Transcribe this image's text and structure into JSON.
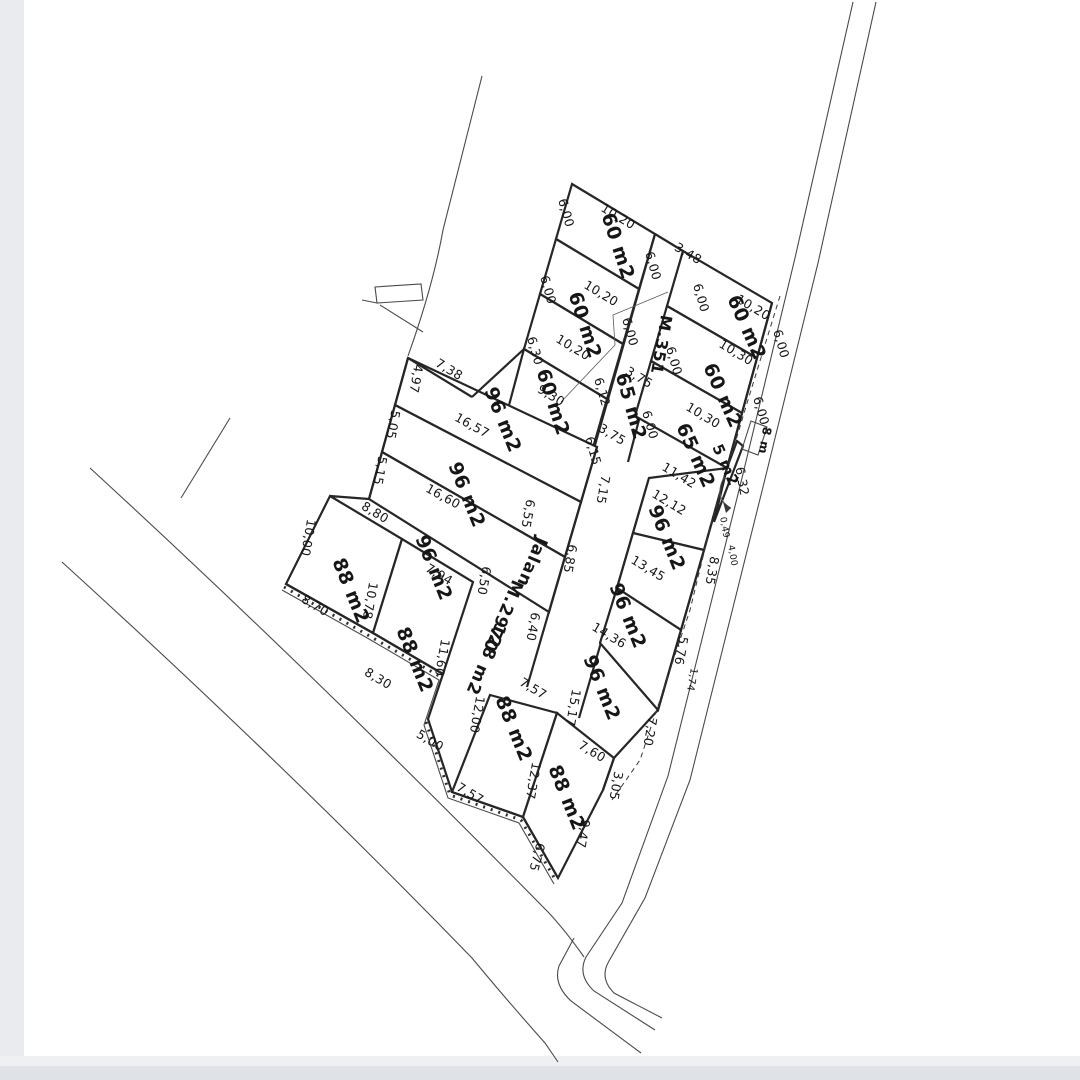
{
  "drawing": {
    "type": "land-subdivision-survey-plan",
    "paper_color": "#ffffff",
    "line_color": "#262626",
    "edge_band_color": "#e9ebee",
    "bottom_band_color": "#dfe3e7"
  },
  "roads": {
    "main_road_name": "Jalan",
    "main_road_id": "M.2970",
    "main_road_area": "128 m2",
    "corridor_id": "M.351",
    "width_marker": "8 m"
  },
  "plot_areas_summary": [
    "60 m2",
    "60 m2",
    "60 m2",
    "65 m2",
    "60 m2",
    "60 m2",
    "65 m2",
    "5 m2",
    "96 m2",
    "96 m2",
    "96 m2",
    "88 m2",
    "88 m2",
    "96 m2",
    "96 m2",
    "96 m2",
    "88 m2",
    "88 m2"
  ],
  "labels": {
    "areas": [
      {
        "t": "60 m2",
        "x": 612,
        "y": 248,
        "r": 72
      },
      {
        "t": "60 m2",
        "x": 579,
        "y": 327,
        "r": 72
      },
      {
        "t": "60 m2",
        "x": 547,
        "y": 404,
        "r": 72
      },
      {
        "t": "65 m2",
        "x": 625,
        "y": 408,
        "r": 74
      },
      {
        "t": "60 m2",
        "x": 741,
        "y": 330,
        "r": 66
      },
      {
        "t": "60 m2",
        "x": 717,
        "y": 398,
        "r": 66
      },
      {
        "t": "65 m2",
        "x": 690,
        "y": 458,
        "r": 66
      },
      {
        "t": "5 m2",
        "x": 721,
        "y": 467,
        "r": 66,
        "s": 15
      },
      {
        "t": "96 m2",
        "x": 497,
        "y": 422,
        "r": 68
      },
      {
        "t": "96 m2",
        "x": 461,
        "y": 497,
        "r": 68
      },
      {
        "t": "96 m2",
        "x": 428,
        "y": 570,
        "r": 68
      },
      {
        "t": "88 m2",
        "x": 345,
        "y": 593,
        "r": 68
      },
      {
        "t": "88 m2",
        "x": 409,
        "y": 662,
        "r": 68
      },
      {
        "t": "96 m2",
        "x": 661,
        "y": 540,
        "r": 68
      },
      {
        "t": "96 m2",
        "x": 622,
        "y": 618,
        "r": 68
      },
      {
        "t": "96 m2",
        "x": 596,
        "y": 690,
        "r": 68
      },
      {
        "t": "88 m2",
        "x": 508,
        "y": 731,
        "r": 68
      },
      {
        "t": "88 m2",
        "x": 561,
        "y": 800,
        "r": 68
      }
    ],
    "roads": [
      {
        "t": "Jalan",
        "x": 527,
        "y": 560,
        "r": 113,
        "s": 17
      },
      {
        "t": "M.2970",
        "x": 498,
        "y": 614,
        "r": 113,
        "s": 17
      },
      {
        "t": "128 m2",
        "x": 481,
        "y": 657,
        "r": 113,
        "s": 17
      },
      {
        "t": "M.351",
        "x": 656,
        "y": 344,
        "r": 100,
        "s": 16
      },
      {
        "t": "8 m",
        "x": 761,
        "y": 440,
        "r": 100,
        "s": 12
      }
    ],
    "dims": [
      {
        "t": "6,00",
        "x": 562,
        "y": 214,
        "r": 74
      },
      {
        "t": "10,20",
        "x": 616,
        "y": 220,
        "r": 31
      },
      {
        "t": "10,20",
        "x": 599,
        "y": 297,
        "r": 31
      },
      {
        "t": "6,00",
        "x": 544,
        "y": 291,
        "r": 74
      },
      {
        "t": "10,20",
        "x": 571,
        "y": 351,
        "r": 31
      },
      {
        "t": "6,30",
        "x": 531,
        "y": 352,
        "r": 74
      },
      {
        "t": "9,30",
        "x": 549,
        "y": 399,
        "r": 31
      },
      {
        "t": "6,00",
        "x": 649,
        "y": 267,
        "r": 74
      },
      {
        "t": "6,00",
        "x": 626,
        "y": 333,
        "r": 74
      },
      {
        "t": "3,48",
        "x": 686,
        "y": 257,
        "r": 31
      },
      {
        "t": "6,00",
        "x": 697,
        "y": 299,
        "r": 74
      },
      {
        "t": "3,75",
        "x": 637,
        "y": 381,
        "r": 31
      },
      {
        "t": "3,75",
        "x": 610,
        "y": 438,
        "r": 31
      },
      {
        "t": "6,12",
        "x": 598,
        "y": 393,
        "r": 74
      },
      {
        "t": "6,15",
        "x": 589,
        "y": 452,
        "r": 74
      },
      {
        "t": "10,20",
        "x": 751,
        "y": 311,
        "r": 31
      },
      {
        "t": "10,30",
        "x": 734,
        "y": 356,
        "r": 31
      },
      {
        "t": "6,00",
        "x": 777,
        "y": 345,
        "r": 74
      },
      {
        "t": "10,30",
        "x": 701,
        "y": 419,
        "r": 31
      },
      {
        "t": "6,00",
        "x": 670,
        "y": 362,
        "r": 74
      },
      {
        "t": "6,00",
        "x": 646,
        "y": 426,
        "r": 74
      },
      {
        "t": "6,00",
        "x": 757,
        "y": 412,
        "r": 74
      },
      {
        "t": "11,42",
        "x": 677,
        "y": 479,
        "r": 31
      },
      {
        "t": "12,12",
        "x": 667,
        "y": 506,
        "r": 31
      },
      {
        "t": "6,32",
        "x": 738,
        "y": 482,
        "r": 80
      },
      {
        "t": "0,49",
        "x": 722,
        "y": 528,
        "r": 80,
        "s": 9
      },
      {
        "t": "4,00",
        "x": 730,
        "y": 556,
        "r": 80,
        "s": 9
      },
      {
        "t": "7,38",
        "x": 447,
        "y": 373,
        "r": 31
      },
      {
        "t": "4,97",
        "x": 412,
        "y": 378,
        "r": 100
      },
      {
        "t": "5,05",
        "x": 389,
        "y": 424,
        "r": 100
      },
      {
        "t": "5,15",
        "x": 376,
        "y": 470,
        "r": 100
      },
      {
        "t": "16,57",
        "x": 470,
        "y": 429,
        "r": 29
      },
      {
        "t": "16,60",
        "x": 441,
        "y": 500,
        "r": 29
      },
      {
        "t": "6,55",
        "x": 524,
        "y": 513,
        "r": 100
      },
      {
        "t": "8,80",
        "x": 373,
        "y": 516,
        "r": 31
      },
      {
        "t": "7,94",
        "x": 437,
        "y": 578,
        "r": 31
      },
      {
        "t": "6,50",
        "x": 480,
        "y": 580,
        "r": 100
      },
      {
        "t": "10,00",
        "x": 304,
        "y": 537,
        "r": 100
      },
      {
        "t": "8,70",
        "x": 313,
        "y": 609,
        "r": 31
      },
      {
        "t": "10,78",
        "x": 366,
        "y": 600,
        "r": 100
      },
      {
        "t": "8,30",
        "x": 376,
        "y": 682,
        "r": 31
      },
      {
        "t": "11,60",
        "x": 438,
        "y": 657,
        "r": 100
      },
      {
        "t": "12,00",
        "x": 473,
        "y": 714,
        "r": 100
      },
      {
        "t": "5,00",
        "x": 428,
        "y": 744,
        "r": 31
      },
      {
        "t": "7,57",
        "x": 531,
        "y": 692,
        "r": 31
      },
      {
        "t": "7,57",
        "x": 468,
        "y": 797,
        "r": 31
      },
      {
        "t": "15,17",
        "x": 569,
        "y": 707,
        "r": 100
      },
      {
        "t": "7,15",
        "x": 599,
        "y": 489,
        "r": 100
      },
      {
        "t": "6,85",
        "x": 566,
        "y": 558,
        "r": 100
      },
      {
        "t": "6,40",
        "x": 529,
        "y": 626,
        "r": 100
      },
      {
        "t": "13,45",
        "x": 646,
        "y": 572,
        "r": 31
      },
      {
        "t": "14,36",
        "x": 607,
        "y": 639,
        "r": 31
      },
      {
        "t": "8,35",
        "x": 708,
        "y": 570,
        "r": 100
      },
      {
        "t": "5,76",
        "x": 677,
        "y": 650,
        "r": 100
      },
      {
        "t": "1,74",
        "x": 689,
        "y": 679,
        "r": 100,
        "s": 10
      },
      {
        "t": "7,20",
        "x": 646,
        "y": 731,
        "r": 100
      },
      {
        "t": "7,60",
        "x": 590,
        "y": 755,
        "r": 31
      },
      {
        "t": "3,05",
        "x": 612,
        "y": 785,
        "r": 100
      },
      {
        "t": "12,37",
        "x": 529,
        "y": 780,
        "r": 100
      },
      {
        "t": "9,47",
        "x": 579,
        "y": 833,
        "r": 100
      },
      {
        "t": "6,75",
        "x": 533,
        "y": 856,
        "r": 105
      }
    ]
  }
}
